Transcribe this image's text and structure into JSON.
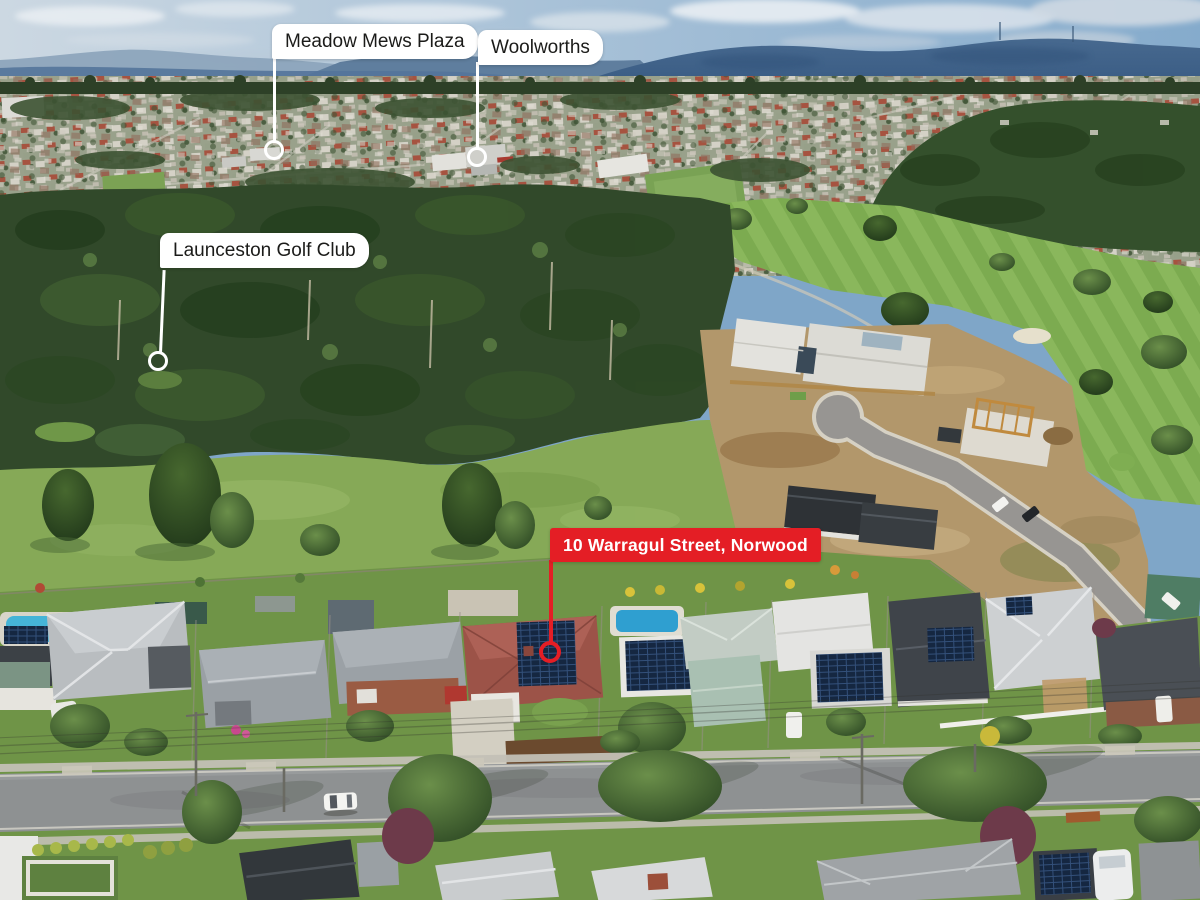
{
  "annotations": {
    "meadow_mews": {
      "label": "Meadow Mews Plaza"
    },
    "woolworths": {
      "label": "Woolworths"
    },
    "golf_club": {
      "label": "Launceston Golf Club"
    },
    "property": {
      "label": "10 Warragul Street, Norwood"
    }
  },
  "colors": {
    "property_accent": "#e41e25",
    "callout_bg": "#ffffff",
    "callout_text": "#1b1b19",
    "property_label_text": "#ffffff"
  }
}
